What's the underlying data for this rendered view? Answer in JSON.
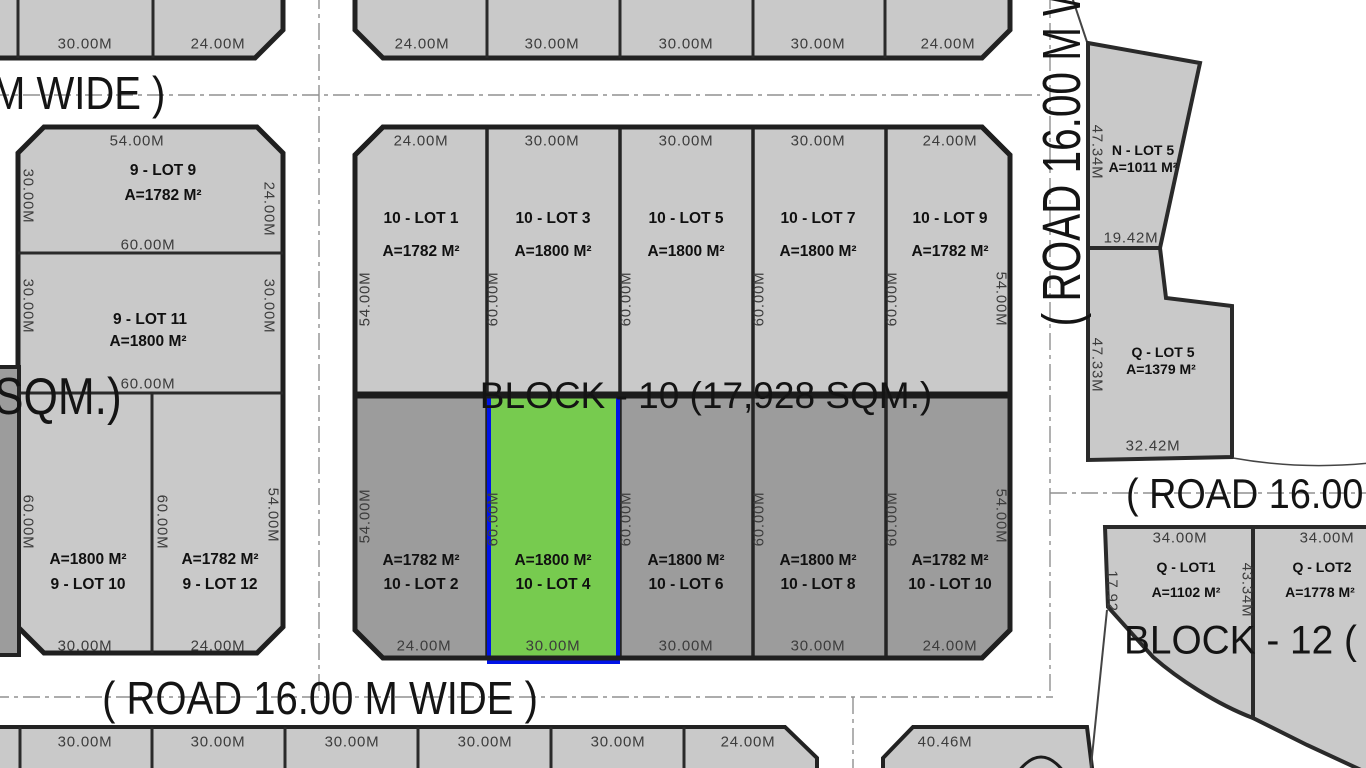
{
  "colors": {
    "lot_light": "#c9c9c9",
    "lot_dark": "#9c9c9c",
    "highlight_green": "#77cb4f",
    "highlight_border": "#0013e8",
    "line": "#222222",
    "dim_text": "#3c3c3c",
    "road_dash": "#909090"
  },
  "roads": {
    "top_left": "M WIDE )",
    "bottom": "( ROAD 16.00 M WIDE )",
    "right_vertical": "( ROAD 16.00 M W",
    "right_horizontal": "( ROAD 16.00"
  },
  "top_strip": {
    "left_dims": [
      "30.00M",
      "24.00M"
    ],
    "center_dims": [
      "24.00M",
      "30.00M",
      "30.00M",
      "30.00M",
      "24.00M"
    ]
  },
  "block9": {
    "partial_label": "SQM.)",
    "lot9": {
      "name": "9 - LOT 9",
      "area": "A=1782 M²",
      "top": "54.00M",
      "left": "30.00M",
      "right": "24.00M",
      "bottom": "60.00M"
    },
    "lot11": {
      "name": "9 - LOT 11",
      "area": "A=1800 M²",
      "left": "30.00M",
      "right": "30.00M",
      "bottom": "60.00M"
    },
    "lot10": {
      "name": "9 - LOT 10",
      "area": "A=1800 M²",
      "left": "60.00M",
      "mid": "60.00M",
      "bottom": "30.00M"
    },
    "lot12": {
      "name": "9 - LOT 12",
      "area": "A=1782 M²",
      "right": "54.00M",
      "bottom": "24.00M"
    }
  },
  "block10": {
    "title": "BLOCK - 10 (17,928 SQM.)",
    "top_dims": [
      "24.00M",
      "30.00M",
      "30.00M",
      "30.00M",
      "24.00M"
    ],
    "bottom_dims": [
      "24.00M",
      "30.00M",
      "30.00M",
      "30.00M",
      "24.00M"
    ],
    "top_side_dims": [
      "54.00M",
      "60.00M",
      "60.00M",
      "60.00M",
      "60.00M",
      "54.00M"
    ],
    "bottom_side_dims": [
      "54.00M",
      "60.00M",
      "60.00M",
      "60.00M",
      "60.00M",
      "54.00M"
    ],
    "top_lots": [
      {
        "name": "10 - LOT 1",
        "area": "A=1782 M²"
      },
      {
        "name": "10 - LOT 3",
        "area": "A=1800 M²"
      },
      {
        "name": "10 - LOT 5",
        "area": "A=1800 M²"
      },
      {
        "name": "10 - LOT 7",
        "area": "A=1800 M²"
      },
      {
        "name": "10 - LOT 9",
        "area": "A=1782 M²"
      }
    ],
    "bottom_lots": [
      {
        "name": "10 - LOT 2",
        "area": "A=1782 M²"
      },
      {
        "name": "10 - LOT 4",
        "area": "A=1800 M²"
      },
      {
        "name": "10 - LOT 6",
        "area": "A=1800 M²"
      },
      {
        "name": "10 - LOT 8",
        "area": "A=1800 M²"
      },
      {
        "name": "10 - LOT 10",
        "area": "A=1782 M²"
      }
    ]
  },
  "right_lots": {
    "n5": {
      "name": "N - LOT 5",
      "area": "A=1011 M²",
      "left": "47.34M",
      "bottom": "19.42M"
    },
    "q5": {
      "name": "Q - LOT 5",
      "area": "A=1379 M²",
      "left": "47.33M",
      "bottom": "32.42M"
    }
  },
  "block12": {
    "title": "BLOCK - 12 (",
    "lot1": {
      "name": "Q - LOT1",
      "area": "A=1102 M²",
      "top": "34.00M",
      "left": "17.92",
      "right": "43.34M"
    },
    "lot2": {
      "name": "Q - LOT2",
      "area": "A=1778 M²",
      "top": "34.00M"
    }
  },
  "bottom_strip": {
    "left_dims": [
      "30.00M",
      "30.00M",
      "30.00M",
      "30.00M",
      "30.00M",
      "24.00M"
    ],
    "right_dims": [
      "40.46M"
    ]
  }
}
